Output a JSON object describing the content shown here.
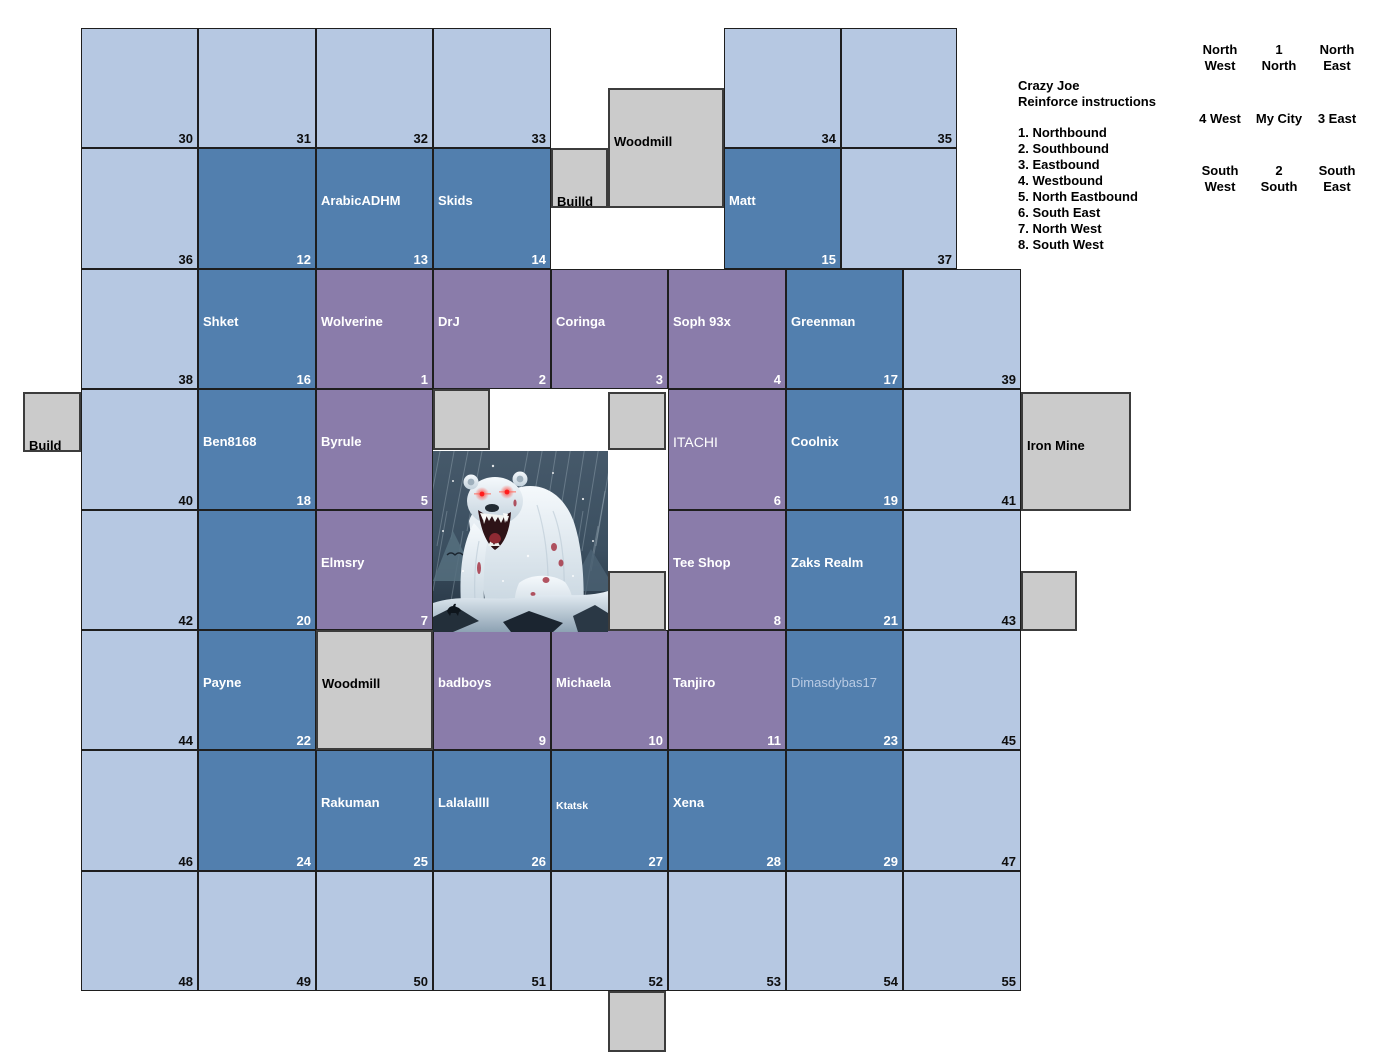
{
  "palette": {
    "light_cell": "#b6c8e2",
    "mid_cell": "#527fae",
    "purple_cell": "#8a7caa",
    "gray_cell": "#cbcbcb",
    "cell_border": "#1e1e1e",
    "gray_border": "#3c3c3c",
    "name_text": "#ffffff",
    "number_dark": "#0e0e0e",
    "faded_name": "#b9cbe4"
  },
  "map": {
    "cells": [
      {
        "id": 30,
        "x": 81,
        "y": 28,
        "w": 117,
        "h": 120,
        "t": "light"
      },
      {
        "id": 31,
        "x": 198,
        "y": 28,
        "w": 118,
        "h": 120,
        "t": "light"
      },
      {
        "id": 32,
        "x": 316,
        "y": 28,
        "w": 117,
        "h": 120,
        "t": "light"
      },
      {
        "id": 33,
        "x": 433,
        "y": 28,
        "w": 118,
        "h": 120,
        "t": "light"
      },
      {
        "id": 34,
        "x": 724,
        "y": 28,
        "w": 117,
        "h": 120,
        "t": "light"
      },
      {
        "id": 35,
        "x": 841,
        "y": 28,
        "w": 116,
        "h": 120,
        "t": "light"
      },
      {
        "id": 36,
        "x": 81,
        "y": 148,
        "w": 117,
        "h": 121,
        "t": "light"
      },
      {
        "id": 12,
        "x": 198,
        "y": 148,
        "w": 118,
        "h": 121,
        "t": "mid"
      },
      {
        "id": 13,
        "x": 316,
        "y": 148,
        "w": 117,
        "h": 121,
        "t": "mid",
        "label": "ArabicADHM"
      },
      {
        "id": 14,
        "x": 433,
        "y": 148,
        "w": 118,
        "h": 121,
        "t": "mid",
        "label": "Skids"
      },
      {
        "id": 15,
        "x": 724,
        "y": 148,
        "w": 117,
        "h": 121,
        "t": "mid",
        "label": "Matt"
      },
      {
        "id": 37,
        "x": 841,
        "y": 148,
        "w": 116,
        "h": 121,
        "t": "light"
      },
      {
        "id": 38,
        "x": 81,
        "y": 269,
        "w": 117,
        "h": 120,
        "t": "light"
      },
      {
        "id": 16,
        "x": 198,
        "y": 269,
        "w": 118,
        "h": 120,
        "t": "mid",
        "label": "Shket"
      },
      {
        "id": 1,
        "x": 316,
        "y": 269,
        "w": 117,
        "h": 120,
        "t": "purple",
        "label": "Wolverine"
      },
      {
        "id": 2,
        "x": 433,
        "y": 269,
        "w": 118,
        "h": 120,
        "t": "purple",
        "label": "DrJ"
      },
      {
        "id": 3,
        "x": 551,
        "y": 269,
        "w": 117,
        "h": 120,
        "t": "purple",
        "label": "Coringa"
      },
      {
        "id": 4,
        "x": 668,
        "y": 269,
        "w": 118,
        "h": 120,
        "t": "purple",
        "label": "Soph 93x"
      },
      {
        "id": 17,
        "x": 786,
        "y": 269,
        "w": 117,
        "h": 120,
        "t": "mid",
        "label": "Greenman"
      },
      {
        "id": 39,
        "x": 903,
        "y": 269,
        "w": 118,
        "h": 120,
        "t": "light"
      },
      {
        "id": 40,
        "x": 81,
        "y": 389,
        "w": 117,
        "h": 121,
        "t": "light"
      },
      {
        "id": 18,
        "x": 198,
        "y": 389,
        "w": 118,
        "h": 121,
        "t": "mid",
        "label": "Ben8168"
      },
      {
        "id": 5,
        "x": 316,
        "y": 389,
        "w": 117,
        "h": 121,
        "t": "purple",
        "label": "Byrule"
      },
      {
        "id": 6,
        "x": 668,
        "y": 389,
        "w": 118,
        "h": 121,
        "t": "purple",
        "label": "ITACHI",
        "variant": "thin"
      },
      {
        "id": 19,
        "x": 786,
        "y": 389,
        "w": 117,
        "h": 121,
        "t": "mid",
        "label": "Coolnix"
      },
      {
        "id": 41,
        "x": 903,
        "y": 389,
        "w": 118,
        "h": 121,
        "t": "light"
      },
      {
        "id": 42,
        "x": 81,
        "y": 510,
        "w": 117,
        "h": 120,
        "t": "light"
      },
      {
        "id": 20,
        "x": 198,
        "y": 510,
        "w": 118,
        "h": 120,
        "t": "mid"
      },
      {
        "id": 7,
        "x": 316,
        "y": 510,
        "w": 117,
        "h": 120,
        "t": "purple",
        "label": "Elmsry"
      },
      {
        "id": 8,
        "x": 668,
        "y": 510,
        "w": 118,
        "h": 120,
        "t": "purple",
        "label": "Tee Shop"
      },
      {
        "id": 21,
        "x": 786,
        "y": 510,
        "w": 117,
        "h": 120,
        "t": "mid",
        "label": "Zaks Realm"
      },
      {
        "id": 43,
        "x": 903,
        "y": 510,
        "w": 118,
        "h": 120,
        "t": "light"
      },
      {
        "id": 44,
        "x": 81,
        "y": 630,
        "w": 117,
        "h": 120,
        "t": "light"
      },
      {
        "id": 22,
        "x": 198,
        "y": 630,
        "w": 118,
        "h": 120,
        "t": "mid",
        "label": "Payne"
      },
      {
        "id": 9,
        "x": 433,
        "y": 630,
        "w": 118,
        "h": 120,
        "t": "purple",
        "label": "badboys"
      },
      {
        "id": 10,
        "x": 551,
        "y": 630,
        "w": 117,
        "h": 120,
        "t": "purple",
        "label": "Michaela"
      },
      {
        "id": 11,
        "x": 668,
        "y": 630,
        "w": 118,
        "h": 120,
        "t": "purple",
        "label": "Tanjiro"
      },
      {
        "id": 23,
        "x": 786,
        "y": 630,
        "w": 117,
        "h": 120,
        "t": "mid",
        "label": "Dimasdybas17",
        "variant": "faded"
      },
      {
        "id": 45,
        "x": 903,
        "y": 630,
        "w": 118,
        "h": 120,
        "t": "light"
      },
      {
        "id": 46,
        "x": 81,
        "y": 750,
        "w": 117,
        "h": 121,
        "t": "light"
      },
      {
        "id": 24,
        "x": 198,
        "y": 750,
        "w": 118,
        "h": 121,
        "t": "mid"
      },
      {
        "id": 25,
        "x": 316,
        "y": 750,
        "w": 117,
        "h": 121,
        "t": "mid",
        "label": "Rakuman"
      },
      {
        "id": 26,
        "x": 433,
        "y": 750,
        "w": 118,
        "h": 121,
        "t": "mid",
        "label": "Lalalallll"
      },
      {
        "id": 27,
        "x": 551,
        "y": 750,
        "w": 117,
        "h": 121,
        "t": "mid",
        "label": "Ktatsk",
        "variant": "small"
      },
      {
        "id": 28,
        "x": 668,
        "y": 750,
        "w": 118,
        "h": 121,
        "t": "mid",
        "label": "Xena"
      },
      {
        "id": 29,
        "x": 786,
        "y": 750,
        "w": 117,
        "h": 121,
        "t": "mid"
      },
      {
        "id": 47,
        "x": 903,
        "y": 750,
        "w": 118,
        "h": 121,
        "t": "light"
      },
      {
        "id": 48,
        "x": 81,
        "y": 871,
        "w": 117,
        "h": 120,
        "t": "light"
      },
      {
        "id": 49,
        "x": 198,
        "y": 871,
        "w": 118,
        "h": 120,
        "t": "light"
      },
      {
        "id": 50,
        "x": 316,
        "y": 871,
        "w": 117,
        "h": 120,
        "t": "light"
      },
      {
        "id": 51,
        "x": 433,
        "y": 871,
        "w": 118,
        "h": 120,
        "t": "light"
      },
      {
        "id": 52,
        "x": 551,
        "y": 871,
        "w": 117,
        "h": 120,
        "t": "light"
      },
      {
        "id": 53,
        "x": 668,
        "y": 871,
        "w": 118,
        "h": 120,
        "t": "light"
      },
      {
        "id": 54,
        "x": 786,
        "y": 871,
        "w": 117,
        "h": 120,
        "t": "light"
      },
      {
        "id": 55,
        "x": 903,
        "y": 871,
        "w": 118,
        "h": 120,
        "t": "light"
      }
    ],
    "structures": [
      {
        "name": "woodmill-north",
        "label": "Woodmill",
        "x": 608,
        "y": 88,
        "w": 116,
        "h": 120
      },
      {
        "name": "builld-plot",
        "label": "Builld",
        "x": 551,
        "y": 148,
        "w": 57,
        "h": 60
      },
      {
        "name": "build-plot-west",
        "label": "Build",
        "x": 23,
        "y": 392,
        "w": 58,
        "h": 60
      },
      {
        "name": "gray-plot-a",
        "x": 433,
        "y": 389,
        "w": 57,
        "h": 61
      },
      {
        "name": "gray-plot-b",
        "x": 608,
        "y": 392,
        "w": 58,
        "h": 58
      },
      {
        "name": "iron-mine",
        "label": "Iron Mine",
        "x": 1021,
        "y": 392,
        "w": 110,
        "h": 119
      },
      {
        "name": "gray-plot-c",
        "x": 608,
        "y": 571,
        "w": 58,
        "h": 60
      },
      {
        "name": "gray-plot-d",
        "x": 1021,
        "y": 571,
        "w": 56,
        "h": 60
      },
      {
        "name": "woodmill-south",
        "label": "Woodmill",
        "x": 316,
        "y": 630,
        "w": 117,
        "h": 120
      },
      {
        "name": "gray-plot-e",
        "x": 608,
        "y": 991,
        "w": 58,
        "h": 61
      }
    ]
  },
  "bear_image": {
    "alt": "Roaring polar bear with glowing red eyes in a snowstorm"
  },
  "instructions": {
    "title_line1": "Crazy Joe",
    "title_line2": "Reinforce instructions",
    "items": [
      "1. Northbound",
      "2. Southbound",
      "3. Eastbound",
      "4. Westbound",
      "5. North Eastbound",
      "6. South East",
      "7. North West",
      "8. South West"
    ]
  },
  "compass": {
    "cells": [
      {
        "name": "north-west",
        "text": "North\nWest",
        "col": 0,
        "row": 0
      },
      {
        "name": "north",
        "text": "1\nNorth",
        "col": 1,
        "row": 0
      },
      {
        "name": "north-east",
        "text": "North\nEast",
        "col": 2,
        "row": 0
      },
      {
        "name": "west",
        "text": "4 West",
        "col": 0,
        "row": 1
      },
      {
        "name": "my-city",
        "text": "My City",
        "col": 1,
        "row": 1
      },
      {
        "name": "east",
        "text": "3 East",
        "col": 2,
        "row": 1
      },
      {
        "name": "south-west",
        "text": "South\nWest",
        "col": 0,
        "row": 2
      },
      {
        "name": "south",
        "text": "2\nSouth",
        "col": 1,
        "row": 2
      },
      {
        "name": "south-east",
        "text": "South\nEast",
        "col": 2,
        "row": 2
      }
    ]
  }
}
